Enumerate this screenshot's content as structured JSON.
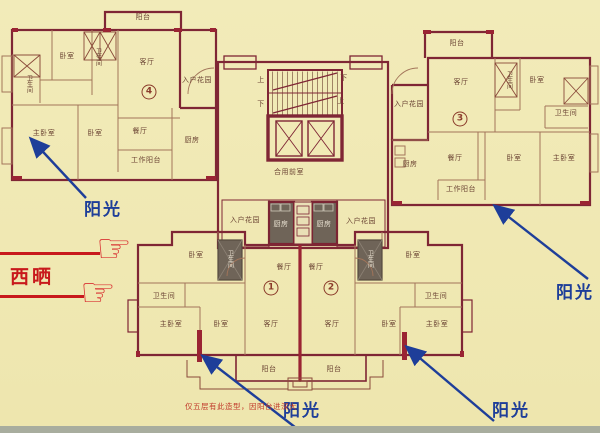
{
  "colors": {
    "background": "#f0e9b6",
    "walls": "#7f2635",
    "accent_wall": "#9a2433",
    "partitions": "#a3755a",
    "dark_room_fill": "#6f6458",
    "annotation_blue": "#1e3e99",
    "annotation_red": "#c8191c"
  },
  "strings": {
    "balcony": "阳台",
    "bedroom": "卧室",
    "master_bedroom": "主卧室",
    "living_room": "客厅",
    "dining_room": "餐厅",
    "kitchen": "厨房",
    "bathroom": "卫生间",
    "work_balcony": "工作阳台",
    "entry_garden": "入户花园",
    "shared_lobby": "合用前室",
    "stair_up": "上",
    "stair_down": "下",
    "unit_1": "1",
    "unit_2": "2",
    "unit_3": "3",
    "unit_4": "4",
    "sunlight": "阳光",
    "west_sun": "西晒",
    "caption": "仅五层有此造型，因阳台进深大"
  }
}
